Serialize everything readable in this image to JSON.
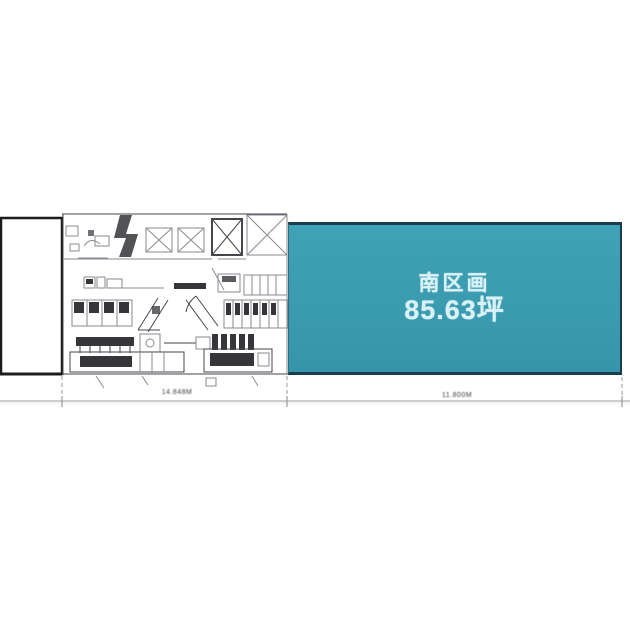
{
  "south_section": {
    "name": "南区画",
    "area": "85.63坪"
  },
  "dimensions": {
    "left_label": "14.848M",
    "right_label": "11.800M"
  },
  "colors": {
    "teal_fill_top": "#3fa2b6",
    "teal_fill_bottom": "#3795ab",
    "teal_border": "#1b3d4d",
    "teal_text": "#d8f2f7",
    "plan_line": "#46464c",
    "plan_line_light": "#8a8a90",
    "plan_dark": "#35353a",
    "dim_line": "#b0b0b0",
    "dim_text": "#3c3c3c",
    "box_border": "#1c1c1c"
  }
}
